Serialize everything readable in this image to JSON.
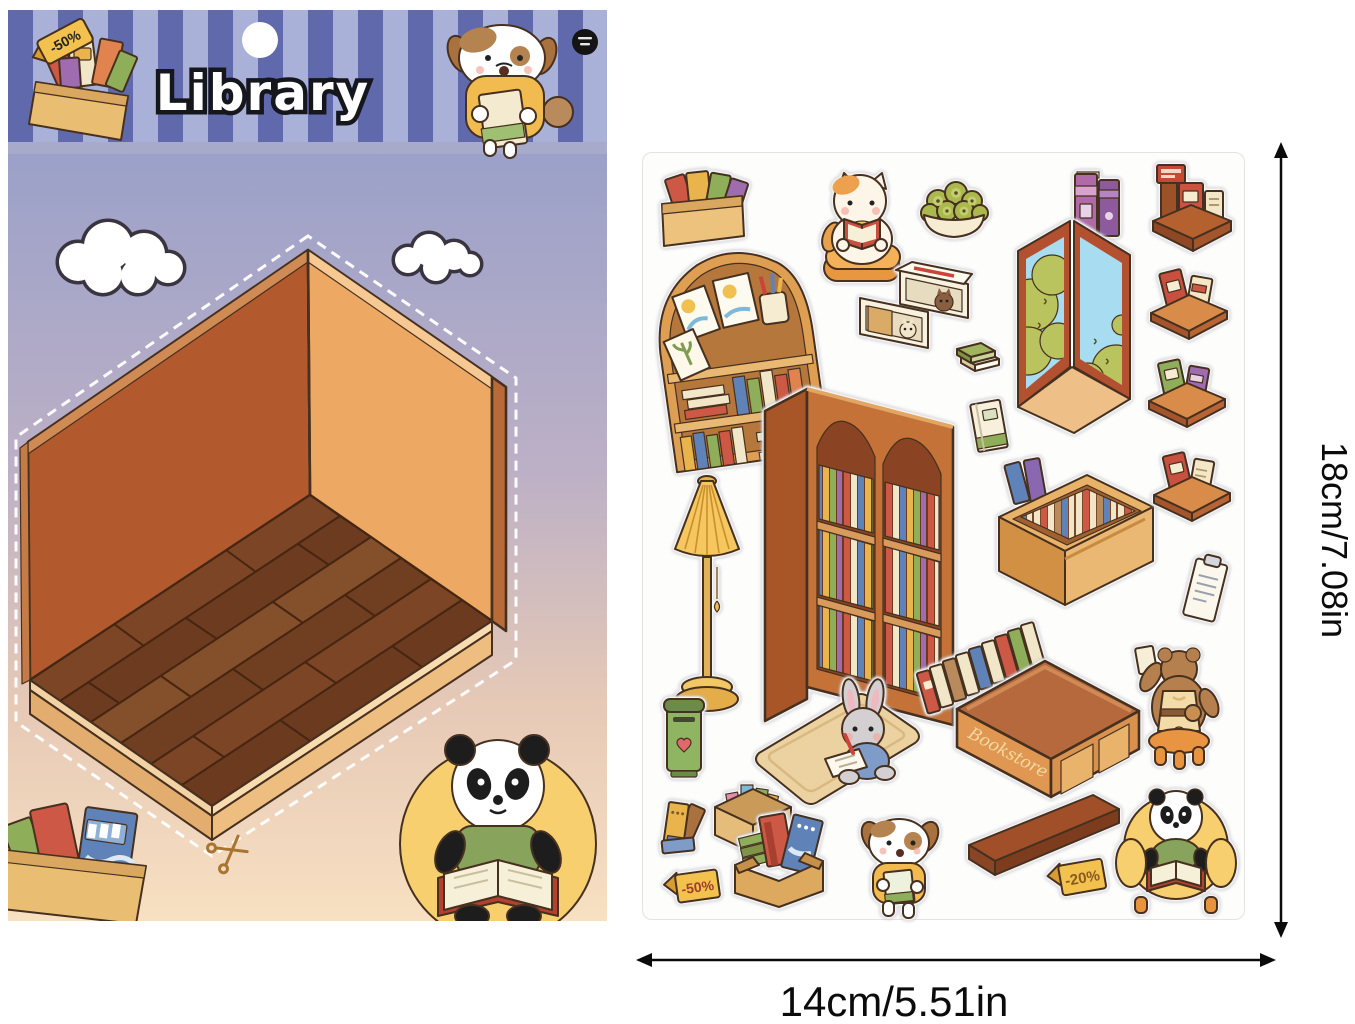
{
  "page": {
    "background": "#ffffff"
  },
  "backing_card": {
    "title": "Library",
    "header_tag": "-50%",
    "elements": {
      "hanging_hole": "hole punch",
      "brand_badge": "black circular logo",
      "header_book_box": "box of books with discount tag",
      "header_dog": "dog holding a book",
      "room": "isometric empty library room with wood floor",
      "clouds": "two outlined clouds",
      "scissors": "cut-here scissors mark",
      "corner_book_box": "box of books (bottom left)",
      "panda_reading": "panda reading in yellow armchair (bottom right)"
    }
  },
  "sticker_sheet": {
    "bookstore_sign": "Bookstore",
    "tag_minus_50": "-50%",
    "tag_minus_20": "-20%",
    "stickers": {
      "box_of_books": {
        "label": "box of books"
      },
      "cat_reading": {
        "label": "cat reading on cushion"
      },
      "fruit_bowl": {
        "label": "bowl of green fruit"
      },
      "purple_books": {
        "label": "two purple books"
      },
      "book_stand": {
        "label": "book display stand"
      },
      "arch_shelf": {
        "label": "arched wall shelf with books and frames"
      },
      "cubby_box": {
        "label": "cubby boxes with hiding cats"
      },
      "window_view": {
        "label": "corner window with garden view"
      },
      "shelf_1": {
        "label": "wall shelf with books"
      },
      "mini_books": {
        "label": "two small stacked books"
      },
      "shelf_2": {
        "label": "wall shelf with green and purple books"
      },
      "floor_lamp": {
        "label": "floor lamp"
      },
      "bookcase": {
        "label": "double arched bookcase"
      },
      "single_book": {
        "label": "single book"
      },
      "low_shelf": {
        "label": "low book counter"
      },
      "shelf_3": {
        "label": "wall shelf with red and cream books"
      },
      "clipboard": {
        "label": "note sheet"
      },
      "books_row": {
        "label": "row of standing books"
      },
      "bear_on_stool": {
        "label": "bear on stool shelving a book"
      },
      "mailbox": {
        "label": "green book-return box"
      },
      "rug_rabbit": {
        "label": "rabbit writing on rug"
      },
      "bookstore_counter": {
        "label": "bookstore counter"
      },
      "washi_box": {
        "label": "box of paper scraps"
      },
      "book_pile": {
        "label": "leaning pile of books"
      },
      "box_books2": {
        "label": "carton of books"
      },
      "dog_reading": {
        "label": "dog holding a book"
      },
      "plank": {
        "label": "wooden plank"
      },
      "tag_20": {
        "label": "-20% price tag"
      },
      "panda_chair": {
        "label": "panda reading in armchair"
      },
      "tag_50": {
        "label": "-50% price tag"
      }
    }
  },
  "dimensions": {
    "height_label": "18cm/7.08in",
    "width_label": "14cm/5.51in"
  },
  "colors": {
    "stripe_dark": "#5f69ac",
    "stripe_light": "#a9b1d9",
    "sky_top": "#9aa0c9",
    "sky_bottom": "#f8e0c2",
    "wall_left": "#b2592e",
    "wall_right": "#eda964",
    "floor_wood": "#6d3c20",
    "plinth": "#e2ad6e",
    "sheet_white": "#fdfdfc",
    "accent_yellow": "#f2c14e",
    "outline_brown": "#46301f"
  }
}
